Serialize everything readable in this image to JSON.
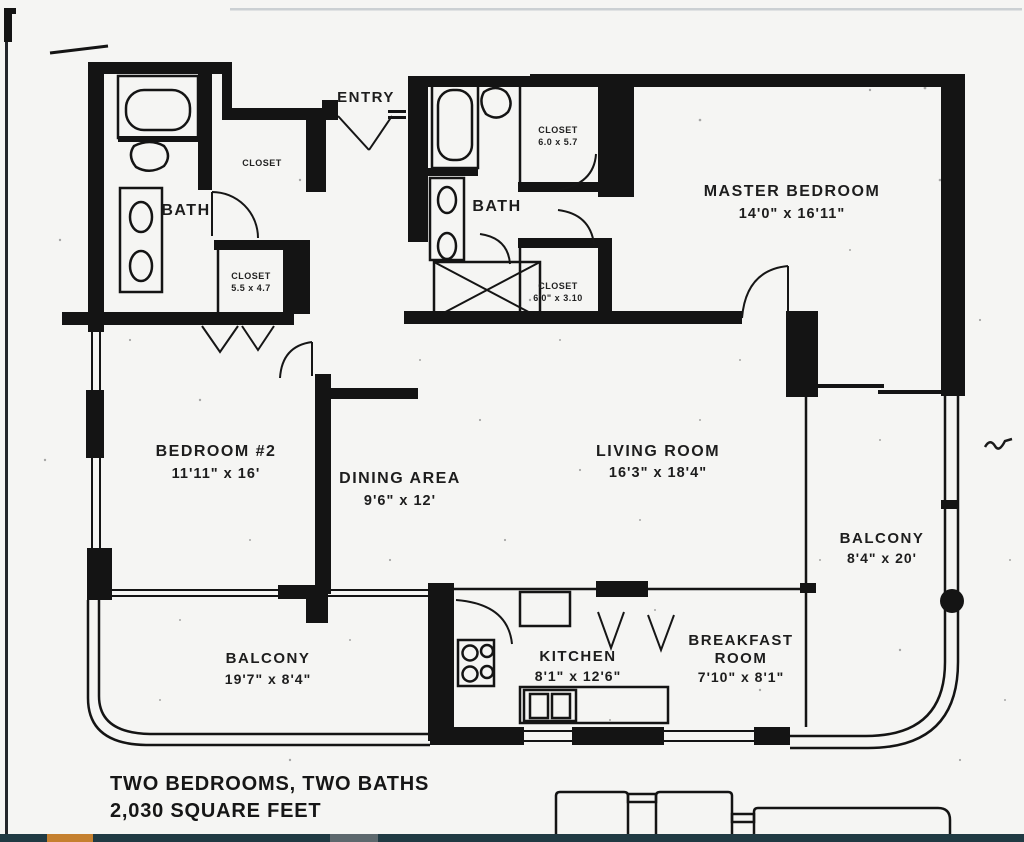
{
  "plan": {
    "entry_label": "ENTRY",
    "bath1_label": "BATH",
    "bath2_label": "BATH",
    "closet_entry": "CLOSET",
    "closet_hall": {
      "name": "CLOSET",
      "size": "5.5 x 4.7"
    },
    "closet_master_top": {
      "name": "CLOSET",
      "size": "6.0 x 5.7"
    },
    "closet_master_bottom": {
      "name": "CLOSET",
      "size": "6'0\" x 3.10"
    },
    "master_bedroom": {
      "name": "MASTER BEDROOM",
      "size": "14'0\" x 16'11\""
    },
    "bedroom2": {
      "name": "BEDROOM #2",
      "size": "11'11\" x 16'"
    },
    "dining": {
      "name": "DINING AREA",
      "size": "9'6\" x 12'"
    },
    "living": {
      "name": "LIVING ROOM",
      "size": "16'3\" x 18'4\""
    },
    "balcony_right": {
      "name": "BALCONY",
      "size": "8'4\" x 20'"
    },
    "balcony_bottom": {
      "name": "BALCONY",
      "size": "19'7\" x 8'4\""
    },
    "kitchen": {
      "name": "KITCHEN",
      "size": "8'1\" x 12'6\""
    },
    "breakfast": {
      "name_line1": "BREAKFAST",
      "name_line2": "ROOM",
      "size": "7'10\" x 8'1\""
    },
    "summary_line1": "TWO BEDROOMS, TWO BATHS",
    "summary_line2": "2,030 SQUARE FEET"
  },
  "colors": {
    "ink": "#141414",
    "paper": "#f5f5f3",
    "footer_bar": "#203a43",
    "footer_orange": "#c5802f",
    "footer_gray": "#5d686d"
  }
}
